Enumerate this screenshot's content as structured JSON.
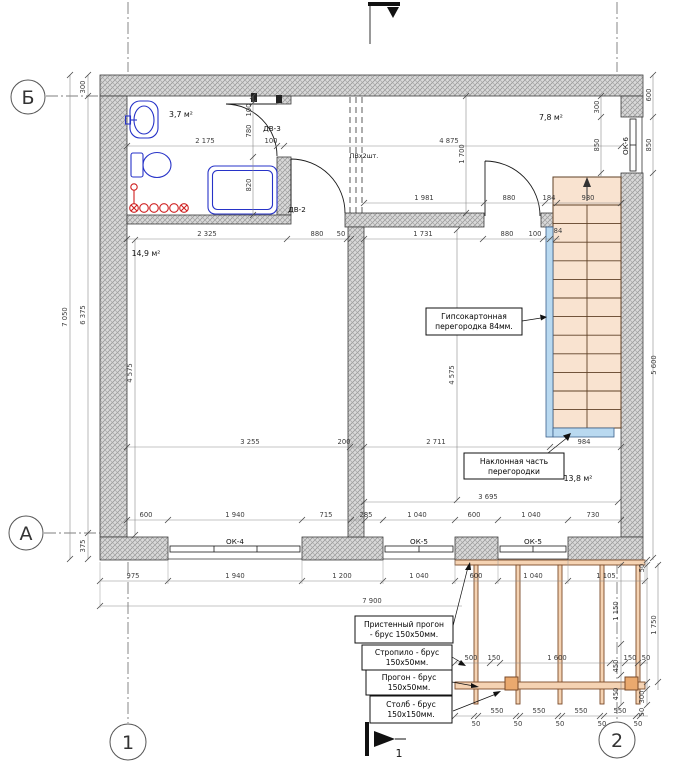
{
  "axes": {
    "b": "Б",
    "a": "А",
    "one": "1",
    "two": "2"
  },
  "section": {
    "bottom_label": "1"
  },
  "rooms": {
    "bathroom_area": "3,7 м²",
    "top_right_area": "7,8 м²",
    "living_area": "14,9 м²",
    "right_room_area": "13,8 м²"
  },
  "labels": {
    "dv3": "ДВ-3",
    "dv2": "ДВ-2",
    "ok4": "ОК-4",
    "ok5a": "ОК-5",
    "ok5b": "ОК-5",
    "ok6": "ОК-6",
    "vent": "ПВх2шт."
  },
  "annotations": {
    "gypsum": {
      "l1": "Гипсокартонная",
      "l2": "перегородка 84мм."
    },
    "incline": {
      "l1": "Наклонная часть",
      "l2": "перегородки"
    },
    "wall_girder": {
      "l1": "Пристенный прогон",
      "l2": "- брус 150х50мм."
    },
    "rafter": {
      "l1": "Стропило - брус",
      "l2": "150х50мм."
    },
    "girder": {
      "l1": "Прогон - брус",
      "l2": "150х50мм."
    },
    "post": {
      "l1": "Столб - брус",
      "l2": "150х150мм."
    }
  },
  "dims": {
    "top": [
      "2 175",
      "100",
      "4 875"
    ],
    "bathv": [
      "100",
      "780",
      "820"
    ],
    "hallv": [
      "1 700"
    ],
    "r199": [
      "1 981",
      "880",
      "184",
      "980"
    ],
    "r236": [
      "2 325",
      "880",
      "50",
      "1 731",
      "880",
      "100",
      "84"
    ],
    "r444": [
      "3 255",
      "200",
      "2 711",
      "984"
    ],
    "r499": [
      "3 695"
    ],
    "roomv": [
      "4 575",
      "4 575"
    ],
    "rightin": [
      "300",
      "850"
    ],
    "rightout": [
      "600",
      "850",
      "5 600"
    ],
    "leftv": [
      "300",
      "7 050",
      "6 375",
      "375"
    ],
    "r517": [
      "600",
      "1 940",
      "715",
      "285",
      "1 040",
      "600",
      "1 040",
      "730"
    ],
    "r578": [
      "975",
      "1 940",
      "1 200",
      "1 040",
      "600",
      "1 040",
      "1 105"
    ],
    "r603": [
      "7 900"
    ],
    "t660": [
      "500",
      "150",
      "1 600",
      "150",
      "50"
    ],
    "t713": [
      "550",
      "550",
      "550",
      "550"
    ],
    "t725": [
      "50",
      "50",
      "50",
      "50",
      "50"
    ],
    "trv": [
      "50",
      "1 750",
      "300",
      "50"
    ],
    "tinv": [
      "1 150",
      "450",
      "450"
    ]
  }
}
